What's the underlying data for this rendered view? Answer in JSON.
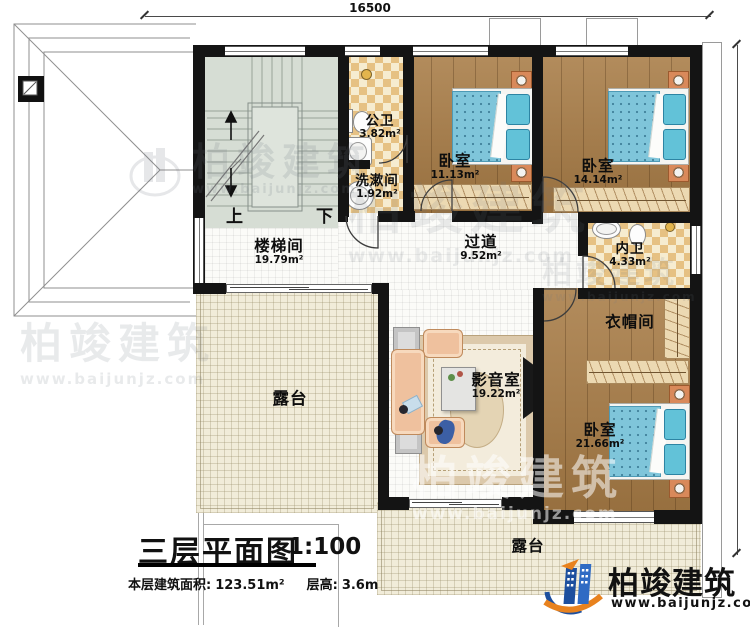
{
  "dimensions": {
    "width": "16500",
    "height": "13400"
  },
  "stair": {
    "up": "上",
    "down": "下"
  },
  "rooms": {
    "public_bath": {
      "name": "公卫",
      "area": "3.82m²"
    },
    "washroom": {
      "name": "洗漱间",
      "area": "1.92m²"
    },
    "bedroom_top": {
      "name": "卧室",
      "area": "11.13m²"
    },
    "bedroom_right": {
      "name": "卧室",
      "area": "14.14m²"
    },
    "stairwell": {
      "name": "楼梯间",
      "area": "19.79m²"
    },
    "corridor": {
      "name": "过道",
      "area": "9.52m²"
    },
    "ensuite_bath": {
      "name": "内卫",
      "area": "4.33m²"
    },
    "cloakroom": {
      "name": "衣帽间"
    },
    "media_room": {
      "name": "影音室",
      "area": "19.22m²"
    },
    "bedroom_bottom": {
      "name": "卧室",
      "area": "21.66m²"
    },
    "terrace_left": {
      "name": "露台"
    },
    "terrace_bottom": {
      "name": "露台"
    }
  },
  "title_block": {
    "title": "三层平面图",
    "scale": "1:100",
    "area_label": "本层建筑面积:",
    "area_value": "123.51m²",
    "height_label": "层高:",
    "height_value": "3.6m"
  },
  "brand": {
    "name": "柏竣建筑",
    "website": "www.baijunjz.com"
  },
  "watermark": {
    "name": "柏竣建筑",
    "website": "www.baijunjz.com"
  },
  "colors": {
    "wall": "#141414",
    "wood": "#a87c46",
    "terrace": "#f1ecd9",
    "bath_checker": "#e6c183",
    "stair_floor": "#d6ddd4",
    "bed_blanket": "#7fc5da",
    "brand_blue": "#1d4f9e",
    "brand_orange": "#e8821e"
  }
}
